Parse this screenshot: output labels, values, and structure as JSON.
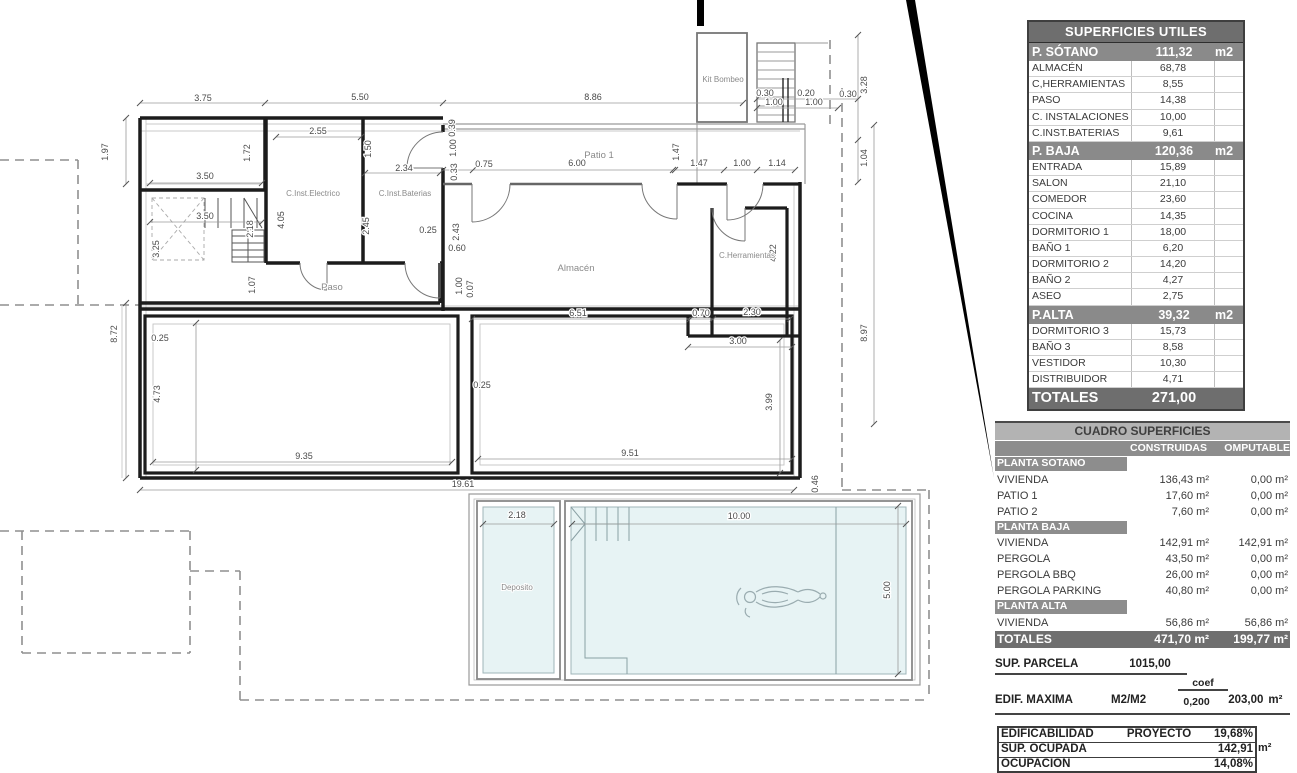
{
  "plan": {
    "rooms": {
      "kit_bombeo": "Kit Bombeo",
      "inst_electrico": "C.Inst.Electrico",
      "inst_baterias": "C.Inst.Baterias",
      "paso": "Paso",
      "patio1": "Patio 1",
      "almacen": "Almacén",
      "herramientas": "C.Herramientas",
      "deposito": "Deposito"
    },
    "dims": [
      "3.75",
      "5.50",
      "8.86",
      "3.50",
      "2.55",
      "2.34",
      "0.25",
      "3.50",
      "0.75",
      "6.00",
      "1.47",
      "1.00",
      "1.14",
      "0.60",
      "6.51",
      "0.70",
      "2.30",
      "3.00",
      "0.30",
      "0.20",
      "0.30",
      "1.00",
      "1.00",
      "0.25",
      "9.35",
      "0.25",
      "9.51",
      "19.61",
      "2.18",
      "10.00",
      "1.97",
      "1.72",
      "1.50",
      "4.05",
      "2.45",
      "2.18",
      "3.25",
      "1.07",
      "0.39",
      "1.00",
      "0.33",
      "1.47",
      "2.43",
      "1.00",
      "0.07",
      "4.22",
      "8.97",
      "3.28",
      "1.04",
      "8.72",
      "4.73",
      "3.99",
      "0.46",
      "5.00"
    ]
  },
  "su": {
    "title": "SUPERFICIES UTILES",
    "rows": [
      {
        "t": "sec",
        "l": "P. SÓTANO",
        "v": "111,32",
        "u": "m2"
      },
      {
        "t": "row",
        "l": "ALMACÉN",
        "v": "68,78"
      },
      {
        "t": "row",
        "l": "C,HERRAMIENTAS",
        "v": "8,55"
      },
      {
        "t": "row",
        "l": "PASO",
        "v": "14,38"
      },
      {
        "t": "row",
        "l": "C. INSTALACIONES",
        "v": "10,00"
      },
      {
        "t": "row",
        "l": "C.INST.BATERIAS",
        "v": "9,61"
      },
      {
        "t": "sec",
        "l": "P. BAJA",
        "v": "120,36",
        "u": "m2"
      },
      {
        "t": "row",
        "l": "ENTRADA",
        "v": "15,89"
      },
      {
        "t": "row",
        "l": "SALON",
        "v": "21,10"
      },
      {
        "t": "row",
        "l": "COMEDOR",
        "v": "23,60"
      },
      {
        "t": "row",
        "l": "COCINA",
        "v": "14,35"
      },
      {
        "t": "row",
        "l": "DORMITORIO 1",
        "v": "18,00"
      },
      {
        "t": "row",
        "l": "BAÑO 1",
        "v": "6,20"
      },
      {
        "t": "row",
        "l": "DORMITORIO 2",
        "v": "14,20"
      },
      {
        "t": "row",
        "l": "BAÑO 2",
        "v": "4,27"
      },
      {
        "t": "row",
        "l": "ASEO",
        "v": "2,75"
      },
      {
        "t": "sec",
        "l": "P.ALTA",
        "v": "39,32",
        "u": "m2"
      },
      {
        "t": "row",
        "l": "DORMITORIO 3",
        "v": "15,73"
      },
      {
        "t": "row",
        "l": "BAÑO 3",
        "v": "8,58"
      },
      {
        "t": "row",
        "l": "VESTIDOR",
        "v": "10,30"
      },
      {
        "t": "row",
        "l": "DISTRIBUIDOR",
        "v": "4,71"
      },
      {
        "t": "tot",
        "l": "TOTALES",
        "v": "271,00"
      }
    ]
  },
  "cuadro": {
    "title": "CUADRO SUPERFICIES",
    "col1": "CONSTRUIDAS",
    "col2": "OMPUTABLE",
    "rows": [
      {
        "t": "sec",
        "l": "PLANTA SOTANO"
      },
      {
        "t": "row",
        "l": "VIVIENDA",
        "v1": "136,43 m²",
        "v2": "0,00 m²"
      },
      {
        "t": "row",
        "l": "PATIO 1",
        "v1": "17,60 m²",
        "v2": "0,00 m²"
      },
      {
        "t": "row",
        "l": "PATIO 2",
        "v1": "7,60 m²",
        "v2": "0,00 m²"
      },
      {
        "t": "sec",
        "l": "PLANTA BAJA"
      },
      {
        "t": "row",
        "l": "VIVIENDA",
        "v1": "142,91 m²",
        "v2": "142,91 m²"
      },
      {
        "t": "row",
        "l": "PERGOLA",
        "v1": "43,50 m²",
        "v2": "0,00 m²"
      },
      {
        "t": "row",
        "l": "PERGOLA BBQ",
        "v1": "26,00 m²",
        "v2": "0,00 m²"
      },
      {
        "t": "row",
        "l": "PERGOLA PARKING",
        "v1": "40,80 m²",
        "v2": "0,00 m²"
      },
      {
        "t": "sec",
        "l": "PLANTA ALTA"
      },
      {
        "t": "row",
        "l": "VIVIENDA",
        "v1": "56,86 m²",
        "v2": "56,86 m²"
      },
      {
        "t": "tot",
        "l": "TOTALES",
        "v1": "471,70 m²",
        "v2": "199,77 m²"
      }
    ]
  },
  "resumen": {
    "parcela_label": "SUP. PARCELA",
    "parcela_value": "1015,00",
    "coef_label": "coef",
    "edif_label": "EDIF. MAXIMA",
    "edif_unit": "M2/M2",
    "edif_coef": "0,200",
    "edif_value": "203,00",
    "edif_value_unit": "m²",
    "box": [
      {
        "l": "EDIFICABILIDAD",
        "m": "PROYECTO",
        "v": "19,68%"
      },
      {
        "l": "SUP. OCUPADA",
        "m": "",
        "v": "142,91"
      },
      {
        "l": "OCUPACION",
        "m": "",
        "v": "14,08%"
      }
    ],
    "box_suffix": "m²"
  }
}
